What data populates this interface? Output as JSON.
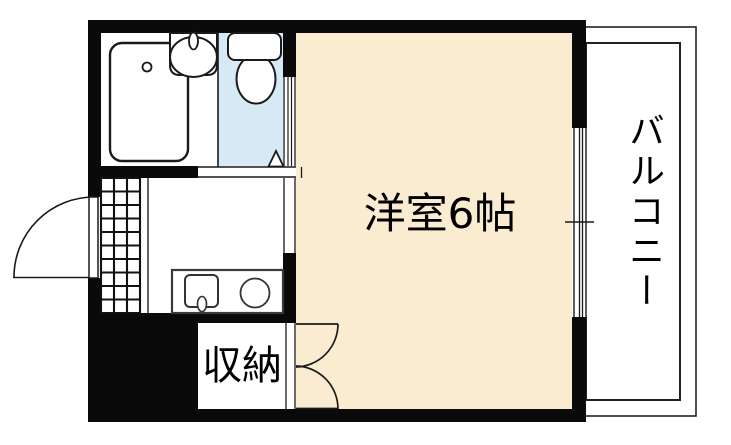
{
  "figure": {
    "type": "apartment-floor-plan",
    "description": "1K unit floor plan with bathroom, toilet, kitchen, western room, closet and balcony"
  },
  "labels": {
    "main_room": "洋室6帖",
    "closet": "収納",
    "balcony": "バルコニー"
  },
  "colors": {
    "room_fill": "#FAECD0",
    "wet_area_fill": "#D6E9F5",
    "wall": "#0a0a0a",
    "line": "#1a1a1a",
    "background": "#ffffff"
  },
  "fixtures": [
    "bathtub",
    "washbasin",
    "toilet",
    "door-swing-triangle",
    "entrance-tile-floor",
    "entrance-door",
    "kitchen-counter",
    "kitchen-sink",
    "kitchen-burner",
    "sliding-door",
    "room-window",
    "closet-double-door",
    "balcony-rail"
  ]
}
